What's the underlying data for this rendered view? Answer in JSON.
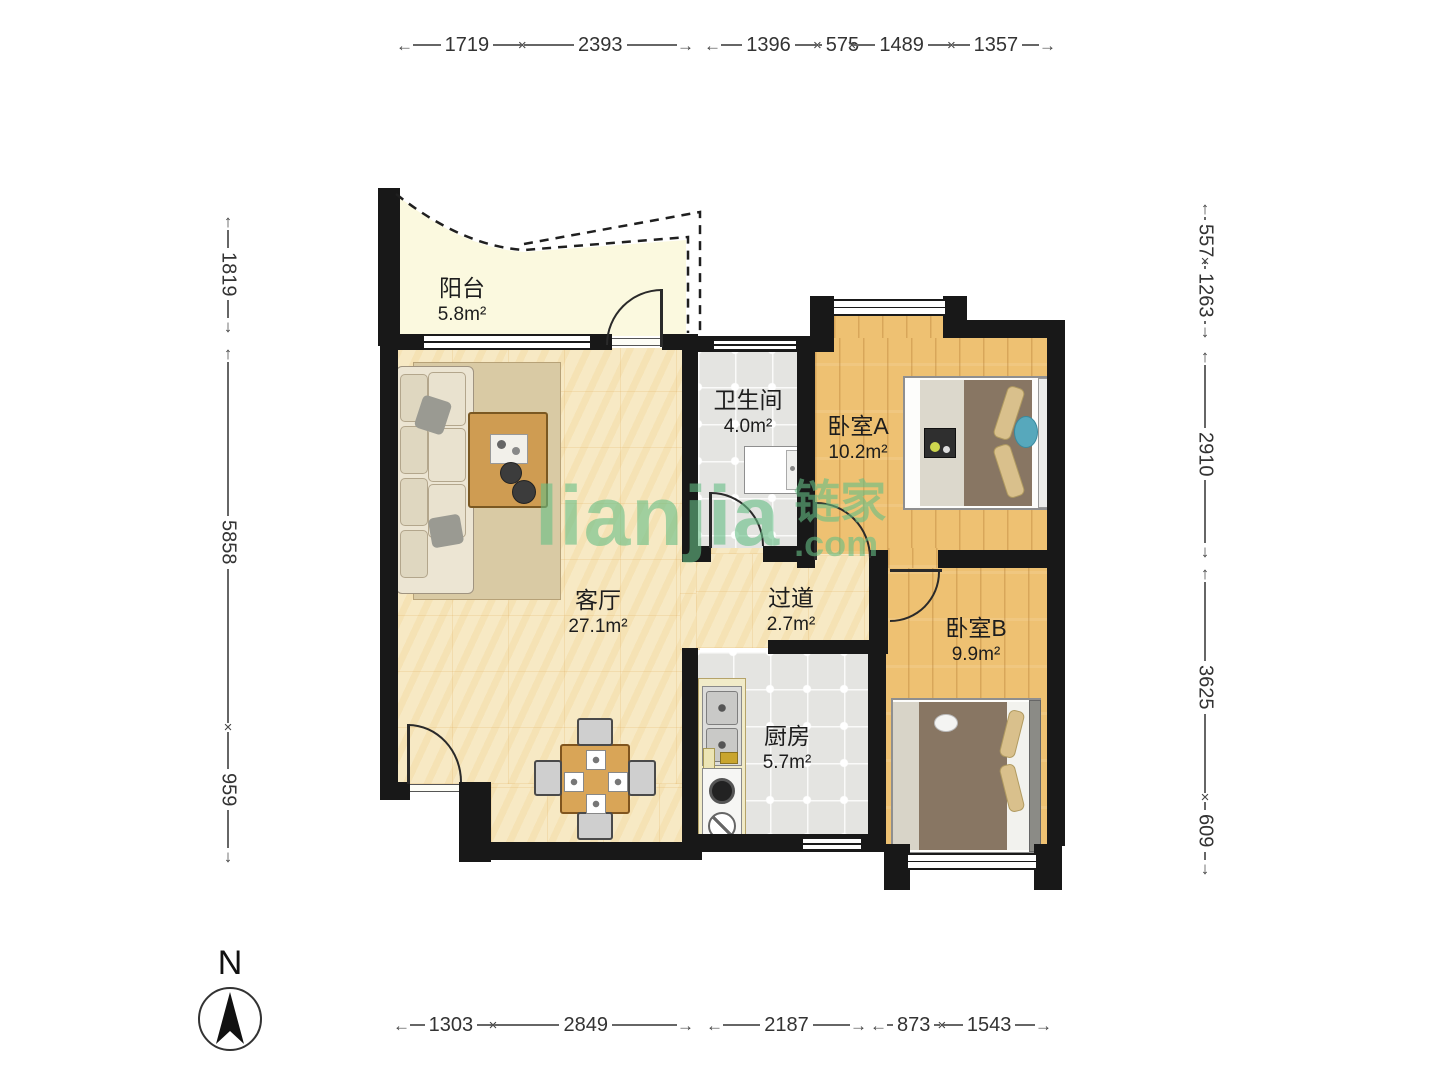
{
  "floorplan": {
    "rooms": {
      "balcony": {
        "name": "阳台",
        "area": "5.8m²"
      },
      "bathroom": {
        "name": "卫生间",
        "area": "4.0m²"
      },
      "bedroom_a": {
        "name": "卧室A",
        "area": "10.2m²"
      },
      "living_room": {
        "name": "客厅",
        "area": "27.1m²"
      },
      "hallway": {
        "name": "过道",
        "area": "2.7m²"
      },
      "bedroom_b": {
        "name": "卧室B",
        "area": "9.9m²"
      },
      "kitchen": {
        "name": "厨房",
        "area": "5.7m²"
      }
    },
    "dimensions_mm": {
      "top": [
        [
          "1719",
          "2393"
        ],
        [
          "1396",
          "575",
          "1489",
          "1357"
        ]
      ],
      "bottom": [
        [
          "1303",
          "2849"
        ],
        [
          "2187"
        ],
        [
          "873",
          "1543"
        ]
      ],
      "left": [
        [
          "1819"
        ],
        [
          "5858",
          "959"
        ]
      ],
      "right": [
        [
          "557",
          "1263"
        ],
        [
          "2910"
        ],
        [
          "3625",
          "609"
        ]
      ]
    },
    "compass": {
      "label": "N"
    },
    "watermark": {
      "brand": "lianjia",
      "brand_cn": "链家",
      "suffix": ".com",
      "color": "#66be86"
    },
    "colors": {
      "wall": "#181818",
      "wood_floor": "#eec172",
      "tile_floor": "#e4e4e1",
      "living_floor": "#f7e9c4",
      "balcony_floor": "#fbf9df"
    }
  }
}
